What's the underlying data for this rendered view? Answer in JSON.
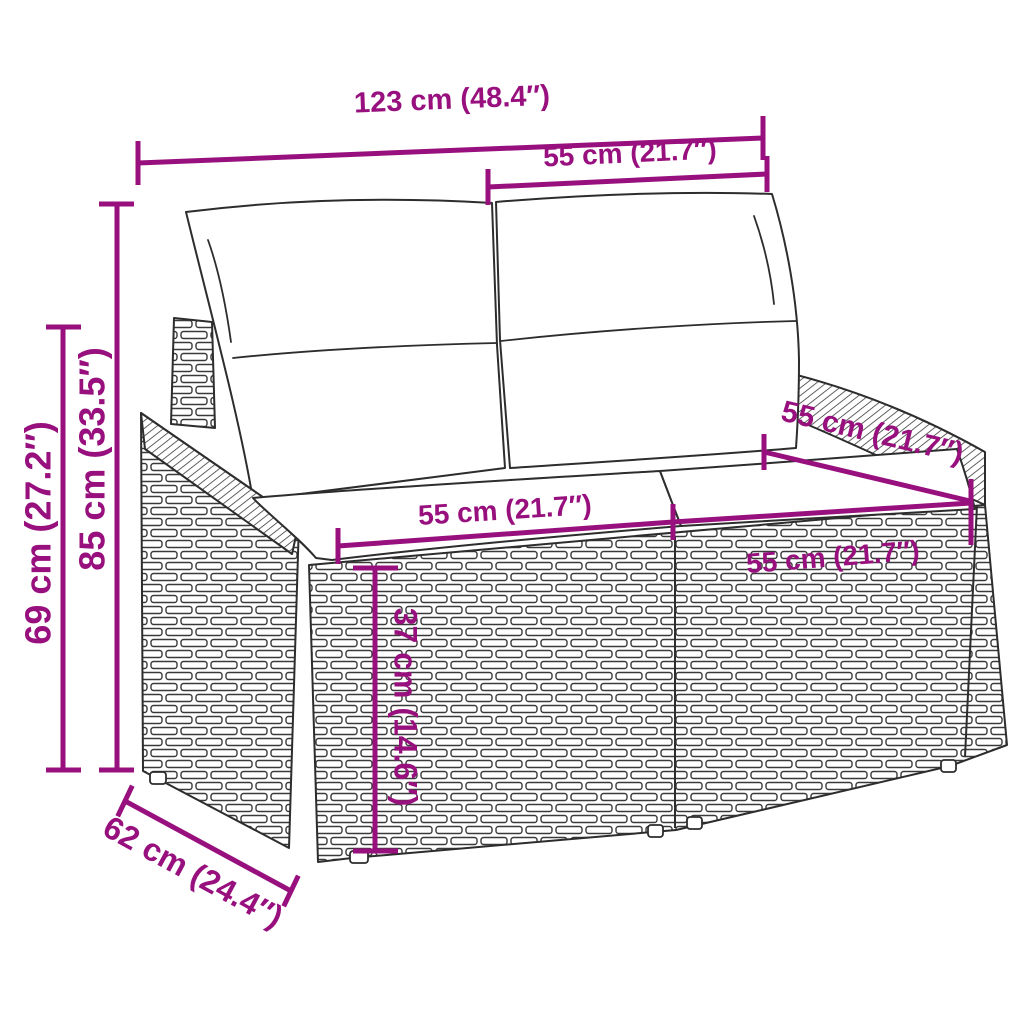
{
  "scene": {
    "subject": "poly rattan 2-seater garden sofa with cushions - dimension diagram",
    "background_color": "#ffffff",
    "accent_color": "#98107E",
    "line_art_color": "#2d2d2d"
  },
  "dimensions": {
    "total_width": "123 cm (48.4″)",
    "back_section_width": "55 cm (21.7″)",
    "back_height": "85 cm (33.5″)",
    "arm_height": "69 cm (27.2″)",
    "seat_width_left": "55 cm (21.7″)",
    "seat_width_right": "55 cm (21.7″)",
    "arm_depth": "55 cm (21.7″)",
    "seat_height": "37 cm (14.6″)",
    "depth": "62 cm (24.4″)"
  }
}
